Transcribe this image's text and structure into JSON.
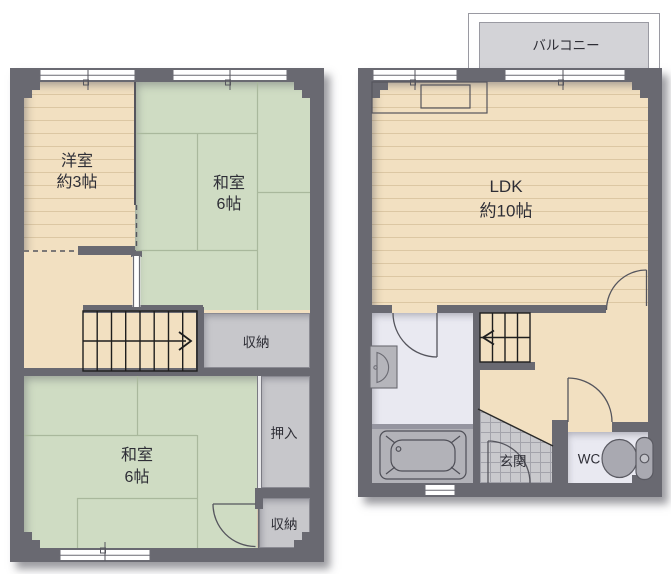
{
  "plans": {
    "first_floor": {
      "balcony": "バルコニー",
      "ldk_name": "LDK",
      "ldk_size": "約10帖",
      "genkan": "玄関",
      "wc": "WC"
    },
    "second_floor": {
      "western_room_name": "洋室",
      "western_room_size": "約3帖",
      "tatami_room_upper_name": "和室",
      "tatami_room_upper_size": "6帖",
      "storage_mid": "収納",
      "closet": "押入",
      "tatami_room_lower_name": "和室",
      "tatami_room_lower_size": "6帖",
      "storage_bottom": "収納"
    }
  },
  "colors": {
    "wall": "#696971",
    "wood_floor": "#f2e0c1",
    "tatami": "#cfdcc3",
    "storage_gray": "#c7c7cb",
    "wet_area": "#e9e9f1",
    "balcony_gray": "#d3d3d7",
    "entry_tile": "#c9c9cd",
    "fixture_gray": "#a9a9b1",
    "line_dark": "#55555d"
  }
}
